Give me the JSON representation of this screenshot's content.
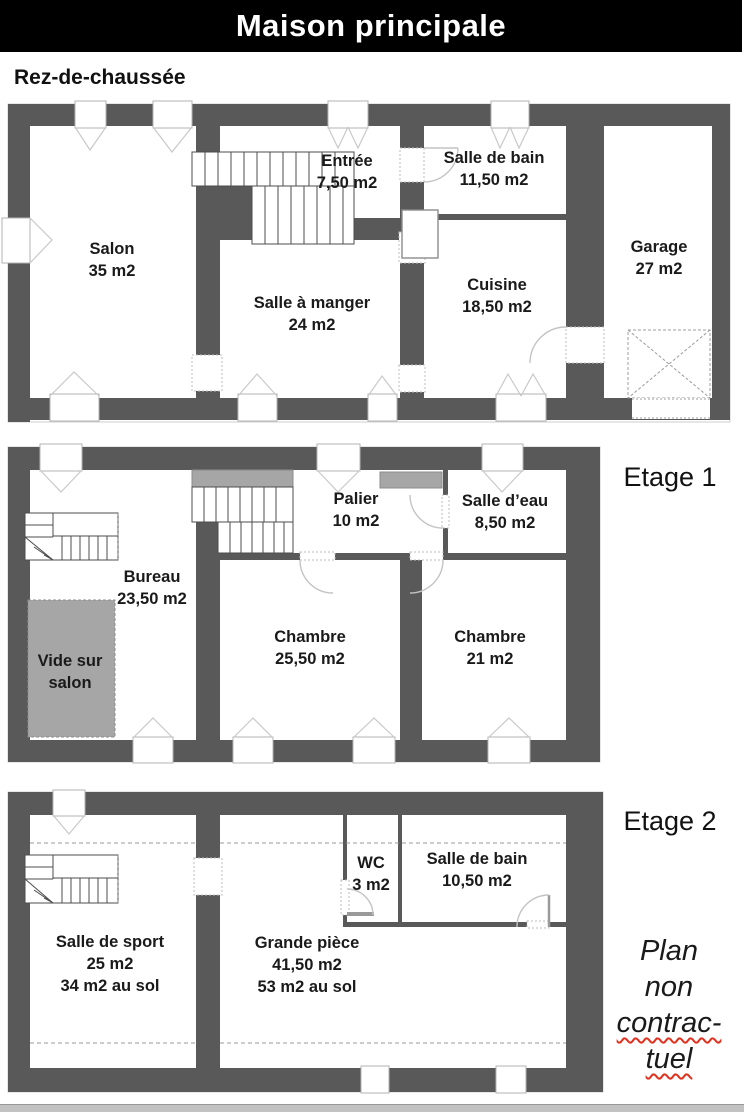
{
  "title": "Maison principale",
  "floors": [
    {
      "id": "rdc",
      "label": "Rez-de-chaussée",
      "rooms": [
        {
          "name": "Salon",
          "area": "35 m2"
        },
        {
          "name": "Entrée",
          "area": "7,50 m2"
        },
        {
          "name": "Salle de bain",
          "area": "11,50 m2"
        },
        {
          "name": "Salle à manger",
          "area": "24 m2"
        },
        {
          "name": "Cuisine",
          "area": "18,50 m2"
        },
        {
          "name": "Garage",
          "area": "27 m2"
        }
      ]
    },
    {
      "id": "etage1",
      "label": "Etage 1",
      "rooms": [
        {
          "name": "Palier",
          "area": "10 m2"
        },
        {
          "name": "Salle d’eau",
          "area": "8,50 m2"
        },
        {
          "name": "Bureau",
          "area": "23,50 m2"
        },
        {
          "name": "Vide sur",
          "area": "salon"
        },
        {
          "name": "Chambre",
          "area": "25,50 m2"
        },
        {
          "name": "Chambre",
          "area": "21 m2"
        }
      ]
    },
    {
      "id": "etage2",
      "label": "Etage 2",
      "rooms": [
        {
          "name": "WC",
          "area": "3 m2"
        },
        {
          "name": "Salle de bain",
          "area": "10,50 m2"
        },
        {
          "name": "Salle de sport",
          "area": "25 m2",
          "area_sol": "34 m2 au sol"
        },
        {
          "name": "Grande pièce",
          "area": "41,50 m2",
          "area_sol": "53 m2 au sol"
        }
      ]
    }
  ],
  "disclaimer": {
    "lines": [
      "Plan",
      "non",
      "contrac-",
      "tuel"
    ]
  },
  "colors": {
    "wall": "#595959",
    "void_gray": "#a6a6a6",
    "title_bg": "#000000",
    "underline_red": "#e0311f"
  }
}
